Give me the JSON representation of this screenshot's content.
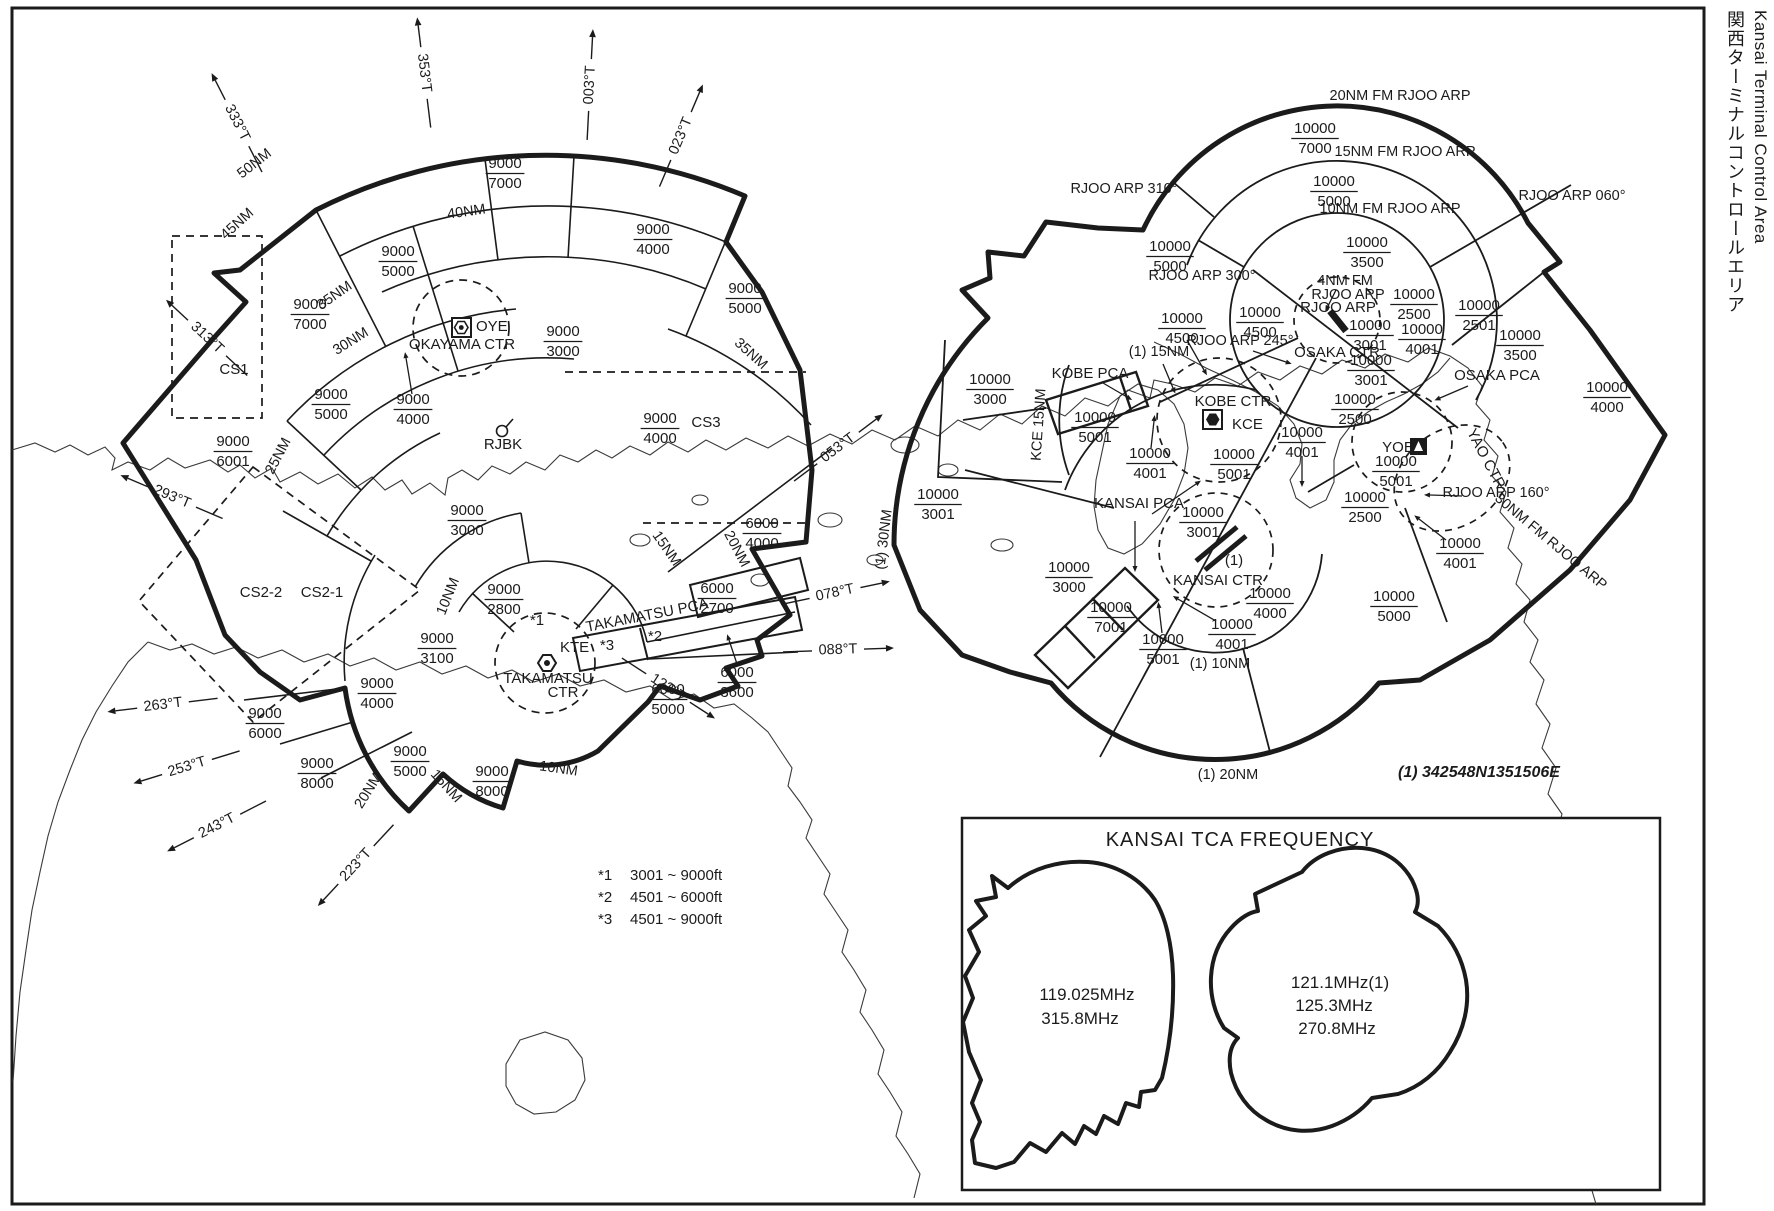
{
  "page_title": {
    "japanese": "関西ターミナルコントロールエリア",
    "english": "Kansai Terminal Control Area"
  },
  "coordinate_note": "(1) 342548N1351506E",
  "notes": [
    {
      "marker": "*1",
      "range": "3001 ~ 9000ft"
    },
    {
      "marker": "*2",
      "range": "4501 ~ 6000ft"
    },
    {
      "marker": "*3",
      "range": "4501 ~ 9000ft"
    }
  ],
  "frequency_box": {
    "title": "KANSAI  TCA  FREQUENCY",
    "west_sector_freqs": [
      "119.025MHz",
      "315.8MHz"
    ],
    "east_sector_freqs": [
      "121.1MHz(1)",
      "125.3MHz",
      "270.8MHz"
    ]
  },
  "left_tca": {
    "name": "Takamatsu sector",
    "altitude_labels": [
      {
        "x": 505,
        "y": 172,
        "upper": "9000",
        "lower": "7000"
      },
      {
        "x": 398,
        "y": 260,
        "upper": "9000",
        "lower": "5000"
      },
      {
        "x": 653,
        "y": 238,
        "upper": "9000",
        "lower": "4000"
      },
      {
        "x": 745,
        "y": 297,
        "upper": "9000",
        "lower": "5000"
      },
      {
        "x": 310,
        "y": 313,
        "upper": "9000",
        "lower": "7000"
      },
      {
        "x": 331,
        "y": 403,
        "upper": "9000",
        "lower": "5000"
      },
      {
        "x": 413,
        "y": 408,
        "upper": "9000",
        "lower": "4000"
      },
      {
        "x": 233,
        "y": 450,
        "upper": "9000",
        "lower": "6001"
      },
      {
        "x": 563,
        "y": 340,
        "upper": "9000",
        "lower": "3000"
      },
      {
        "x": 467,
        "y": 519,
        "upper": "9000",
        "lower": "3000"
      },
      {
        "x": 660,
        "y": 427,
        "upper": "9000",
        "lower": "4000"
      },
      {
        "x": 504,
        "y": 598,
        "upper": "9000",
        "lower": "2800"
      },
      {
        "x": 437,
        "y": 647,
        "upper": "9000",
        "lower": "3100"
      },
      {
        "x": 377,
        "y": 692,
        "upper": "9000",
        "lower": "4000"
      },
      {
        "x": 265,
        "y": 722,
        "upper": "9000",
        "lower": "6000"
      },
      {
        "x": 317,
        "y": 772,
        "upper": "9000",
        "lower": "8000"
      },
      {
        "x": 410,
        "y": 760,
        "upper": "9000",
        "lower": "5000"
      },
      {
        "x": 492,
        "y": 780,
        "upper": "9000",
        "lower": "8000"
      },
      {
        "x": 762,
        "y": 532,
        "upper": "6000",
        "lower": "4000"
      },
      {
        "x": 717,
        "y": 597,
        "upper": "6000",
        "lower": "2700"
      },
      {
        "x": 668,
        "y": 698,
        "upper": "6000",
        "lower": "5000"
      },
      {
        "x": 737,
        "y": 681,
        "upper": "6000",
        "lower": "3600"
      }
    ],
    "ring_labels": [
      {
        "t": "50NM",
        "x": 257,
        "y": 167,
        "rot": -38
      },
      {
        "t": "45NM",
        "x": 240,
        "y": 227,
        "rot": -42
      },
      {
        "t": "40NM",
        "x": 467,
        "y": 216,
        "rot": -8
      },
      {
        "t": "35NM",
        "x": 337,
        "y": 299,
        "rot": -35
      },
      {
        "t": "30NM",
        "x": 353,
        "y": 345,
        "rot": -32
      },
      {
        "t": "25NM",
        "x": 282,
        "y": 458,
        "rot": -62
      },
      {
        "t": "35NM",
        "x": 748,
        "y": 357,
        "rot": 42
      },
      {
        "t": "20NM",
        "x": 733,
        "y": 551,
        "rot": 62
      },
      {
        "t": "15NM",
        "x": 663,
        "y": 551,
        "rot": 55
      },
      {
        "t": "10NM",
        "x": 452,
        "y": 598,
        "rot": -68
      },
      {
        "t": "20NM",
        "x": 372,
        "y": 793,
        "rot": -58
      },
      {
        "t": "15NM",
        "x": 443,
        "y": 789,
        "rot": 48
      },
      {
        "t": "10NM",
        "x": 558,
        "y": 773,
        "rot": 8
      }
    ],
    "area_labels": [
      {
        "t": "CS1",
        "x": 234,
        "y": 374
      },
      {
        "t": "CS2-2",
        "x": 261,
        "y": 597
      },
      {
        "t": "CS2-1",
        "x": 322,
        "y": 597
      },
      {
        "t": "CS3",
        "x": 706,
        "y": 427
      },
      {
        "t": "TAKAMATSU  PCA",
        "x": 648,
        "y": 620,
        "rot": -11
      },
      {
        "t": "*1",
        "x": 537,
        "y": 625
      },
      {
        "t": "*2",
        "x": 655,
        "y": 641
      },
      {
        "t": "*3",
        "x": 607,
        "y": 650
      }
    ],
    "facility_labels": [
      {
        "t": "OYE",
        "x": 476,
        "y": 331,
        "anchor": "start"
      },
      {
        "t": "OKAYAMA  CTR",
        "x": 462,
        "y": 349
      },
      {
        "t": "KTE",
        "x": 560,
        "y": 652,
        "anchor": "start"
      },
      {
        "t": "TAKAMATSU",
        "x": 548,
        "y": 683
      },
      {
        "t": "CTR",
        "x": 563,
        "y": 697
      },
      {
        "t": "RJBK",
        "x": 503,
        "y": 449
      }
    ],
    "bearing_arrows": [
      {
        "label": "333°T",
        "deg": 333,
        "x": 237,
        "y": 123
      },
      {
        "label": "353°T",
        "deg": 353,
        "x": 424,
        "y": 73
      },
      {
        "label": "003°T",
        "deg": 3,
        "x": 590,
        "y": 85
      },
      {
        "label": "023°T",
        "deg": 23,
        "x": 681,
        "y": 136
      },
      {
        "label": "313°T",
        "deg": 313,
        "x": 207,
        "y": 338
      },
      {
        "label": "293°T",
        "deg": 293,
        "x": 172,
        "y": 497
      },
      {
        "label": "263°T",
        "deg": 263,
        "x": 163,
        "y": 705
      },
      {
        "label": "253°T",
        "deg": 253,
        "x": 187,
        "y": 767
      },
      {
        "label": "243°T",
        "deg": 243,
        "x": 217,
        "y": 826
      },
      {
        "label": "223°T",
        "deg": 223,
        "x": 356,
        "y": 865
      },
      {
        "label": "123°T",
        "deg": 123,
        "x": 668,
        "y": 688
      },
      {
        "label": "053°T",
        "deg": 53,
        "x": 838,
        "y": 448
      },
      {
        "label": "078°T",
        "deg": 78,
        "x": 835,
        "y": 593
      },
      {
        "label": "088°T",
        "deg": 88,
        "x": 838,
        "y": 650
      }
    ]
  },
  "right_tca": {
    "name": "Kansai sector",
    "altitude_labels": [
      {
        "x": 1315,
        "y": 137,
        "upper": "10000",
        "lower": "7000"
      },
      {
        "x": 1334,
        "y": 190,
        "upper": "10000",
        "lower": "5000"
      },
      {
        "x": 1367,
        "y": 251,
        "upper": "10000",
        "lower": "3500"
      },
      {
        "x": 1170,
        "y": 255,
        "upper": "10000",
        "lower": "5000"
      },
      {
        "x": 1182,
        "y": 327,
        "upper": "10000",
        "lower": "4500"
      },
      {
        "x": 1260,
        "y": 321,
        "upper": "10000",
        "lower": "4500"
      },
      {
        "x": 1414,
        "y": 303,
        "upper": "10000",
        "lower": "2500"
      },
      {
        "x": 1479,
        "y": 314,
        "upper": "10000",
        "lower": "2501"
      },
      {
        "x": 1520,
        "y": 344,
        "upper": "10000",
        "lower": "3500"
      },
      {
        "x": 1370,
        "y": 334,
        "upper": "10000",
        "lower": "3001"
      },
      {
        "x": 1371,
        "y": 369,
        "upper": "10000",
        "lower": "3001"
      },
      {
        "x": 1422,
        "y": 338,
        "upper": "10000",
        "lower": "4001"
      },
      {
        "x": 1607,
        "y": 396,
        "upper": "10000",
        "lower": "4000"
      },
      {
        "x": 1355,
        "y": 408,
        "upper": "10000",
        "lower": "2500"
      },
      {
        "x": 1302,
        "y": 441,
        "upper": "10000",
        "lower": "4001"
      },
      {
        "x": 1234,
        "y": 463,
        "upper": "10000",
        "lower": "5001"
      },
      {
        "x": 1150,
        "y": 462,
        "upper": "10000",
        "lower": "4001"
      },
      {
        "x": 1095,
        "y": 426,
        "upper": "10000",
        "lower": "5001"
      },
      {
        "x": 990,
        "y": 388,
        "upper": "10000",
        "lower": "3000"
      },
      {
        "x": 938,
        "y": 503,
        "upper": "10000",
        "lower": "3001"
      },
      {
        "x": 1069,
        "y": 576,
        "upper": "10000",
        "lower": "3000"
      },
      {
        "x": 1111,
        "y": 616,
        "upper": "10000",
        "lower": "7001"
      },
      {
        "x": 1163,
        "y": 648,
        "upper": "10000",
        "lower": "5001"
      },
      {
        "x": 1203,
        "y": 521,
        "upper": "10000",
        "lower": "3001"
      },
      {
        "x": 1232,
        "y": 633,
        "upper": "10000",
        "lower": "4001"
      },
      {
        "x": 1270,
        "y": 602,
        "upper": "10000",
        "lower": "4000"
      },
      {
        "x": 1394,
        "y": 605,
        "upper": "10000",
        "lower": "5000"
      },
      {
        "x": 1396,
        "y": 470,
        "upper": "10000",
        "lower": "5001"
      },
      {
        "x": 1365,
        "y": 506,
        "upper": "10000",
        "lower": "2500"
      },
      {
        "x": 1460,
        "y": 552,
        "upper": "10000",
        "lower": "4001"
      }
    ],
    "ring_labels": [
      {
        "t": "20NM FM RJOO ARP",
        "x": 1400,
        "y": 100
      },
      {
        "t": "15NM FM RJOO ARP",
        "x": 1405,
        "y": 156
      },
      {
        "t": "10NM FM RJOO ARP",
        "x": 1390,
        "y": 213
      },
      {
        "t": "4NM FM",
        "x": 1345,
        "y": 285
      },
      {
        "t": "RJOO ARP",
        "x": 1348,
        "y": 299
      },
      {
        "t": "30NM FM RJOO ARP",
        "x": 1548,
        "y": 545,
        "rot": 40
      },
      {
        "t": "(1) 10NM",
        "x": 1220,
        "y": 668
      },
      {
        "t": "(1) 20NM",
        "x": 1228,
        "y": 779
      },
      {
        "t": "(1) 30NM",
        "x": 888,
        "y": 540,
        "rot": -83
      },
      {
        "t": "KCE 15NM",
        "x": 1043,
        "y": 425,
        "rot": -86
      },
      {
        "t": "(1) 15NM",
        "x": 1159,
        "y": 356
      }
    ],
    "radial_labels": [
      {
        "t": "RJOO ARP 310°",
        "x": 1124,
        "y": 193
      },
      {
        "t": "RJOO ARP 300°",
        "x": 1202,
        "y": 280
      },
      {
        "t": "RJOO ARP 245°",
        "x": 1240,
        "y": 345
      },
      {
        "t": "RJOO ARP 060°",
        "x": 1572,
        "y": 200
      },
      {
        "t": "RJOO ARP 160°",
        "x": 1496,
        "y": 497,
        "anchor": "middle"
      }
    ],
    "facility_labels": [
      {
        "t": "RJOO ARP",
        "x": 1338,
        "y": 312
      },
      {
        "t": "OSAKA CTR",
        "x": 1337,
        "y": 357
      },
      {
        "t": "KOBE CTR",
        "x": 1233,
        "y": 406
      },
      {
        "t": "KCE",
        "x": 1232,
        "y": 429,
        "anchor": "start"
      },
      {
        "t": "KOBE PCA",
        "x": 1090,
        "y": 378
      },
      {
        "t": "KANSAI PCA",
        "x": 1139,
        "y": 508
      },
      {
        "t": "OSAKA PCA",
        "x": 1497,
        "y": 380
      },
      {
        "t": "YAO CTR",
        "x": 1482,
        "y": 461,
        "rot": 62
      },
      {
        "t": "YOE",
        "x": 1398,
        "y": 452
      },
      {
        "t": "KANSAI CTR",
        "x": 1218,
        "y": 585
      },
      {
        "t": "(1)",
        "x": 1234,
        "y": 565
      }
    ]
  },
  "arrows": [
    {
      "x1": 412,
      "y1": 394,
      "x2": 406,
      "y2": 358
    },
    {
      "x1": 737,
      "y1": 664,
      "x2": 729,
      "y2": 640
    },
    {
      "x1": 1103,
      "y1": 383,
      "x2": 1127,
      "y2": 397
    },
    {
      "x1": 1163,
      "y1": 364,
      "x2": 1173,
      "y2": 388
    },
    {
      "x1": 1253,
      "y1": 351,
      "x2": 1286,
      "y2": 362
    },
    {
      "x1": 1187,
      "y1": 340,
      "x2": 1204,
      "y2": 370
    },
    {
      "x1": 1302,
      "y1": 456,
      "x2": 1302,
      "y2": 481
    },
    {
      "x1": 1151,
      "y1": 448,
      "x2": 1154,
      "y2": 421
    },
    {
      "x1": 1162,
      "y1": 633,
      "x2": 1159,
      "y2": 608
    },
    {
      "x1": 1216,
      "y1": 621,
      "x2": 1178,
      "y2": 599
    },
    {
      "x1": 1446,
      "y1": 540,
      "x2": 1419,
      "y2": 519
    },
    {
      "x1": 1152,
      "y1": 514,
      "x2": 1196,
      "y2": 484
    },
    {
      "x1": 1135,
      "y1": 521,
      "x2": 1135,
      "y2": 566
    },
    {
      "x1": 1468,
      "y1": 386,
      "x2": 1440,
      "y2": 398
    },
    {
      "x1": 1462,
      "y1": 496,
      "x2": 1430,
      "y2": 495
    },
    {
      "x1": 1336,
      "y1": 290,
      "x2": 1328,
      "y2": 306
    }
  ]
}
